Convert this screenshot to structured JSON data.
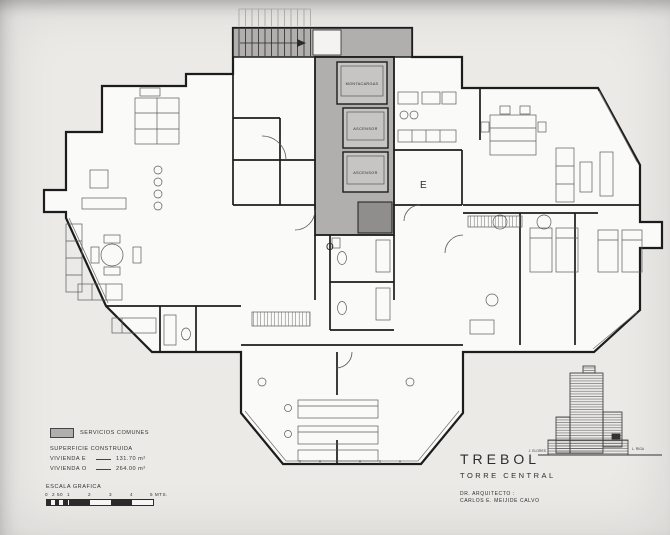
{
  "plan": {
    "core": {
      "montacargas": "MONTACARGAS",
      "ascensor_upper": "ASCENSOR",
      "ascensor_lower": "ASCENSOR"
    },
    "unit_markers": {
      "east": "E",
      "west": "O"
    }
  },
  "legend": {
    "servicios_comunes": "SERVICIOS COMUNES",
    "superficie_construida": "SUPERFICIE CONSTRUIDA",
    "vivienda_e_label": "VIVIENDA   E",
    "vivienda_e_value": "131.70 m²",
    "vivienda_o_label": "VIVIENDA   O",
    "vivienda_o_value": "264.00 m²"
  },
  "scale_bar": {
    "title": "ESCALA GRAFICA",
    "tick_labels": [
      "0",
      "2",
      "50",
      "1",
      "2",
      "3",
      "4",
      "5 MTS."
    ]
  },
  "title_block": {
    "project": "TREBOL",
    "subtitle": "TORRE CENTRAL",
    "architect_label": "DR. ARQUITECTO :",
    "architect_name": "CARLOS E. MEIJIDE CALVO"
  },
  "site_elevation": {
    "label_left": "J. ELORES",
    "label_right": "L. RIGA"
  },
  "colors": {
    "paper": "#eceae7",
    "plan_paper": "#fafaf8",
    "core_gray": "#b0afad",
    "dark_gray": "#8f8e8c",
    "line": "#1c1c1c"
  }
}
